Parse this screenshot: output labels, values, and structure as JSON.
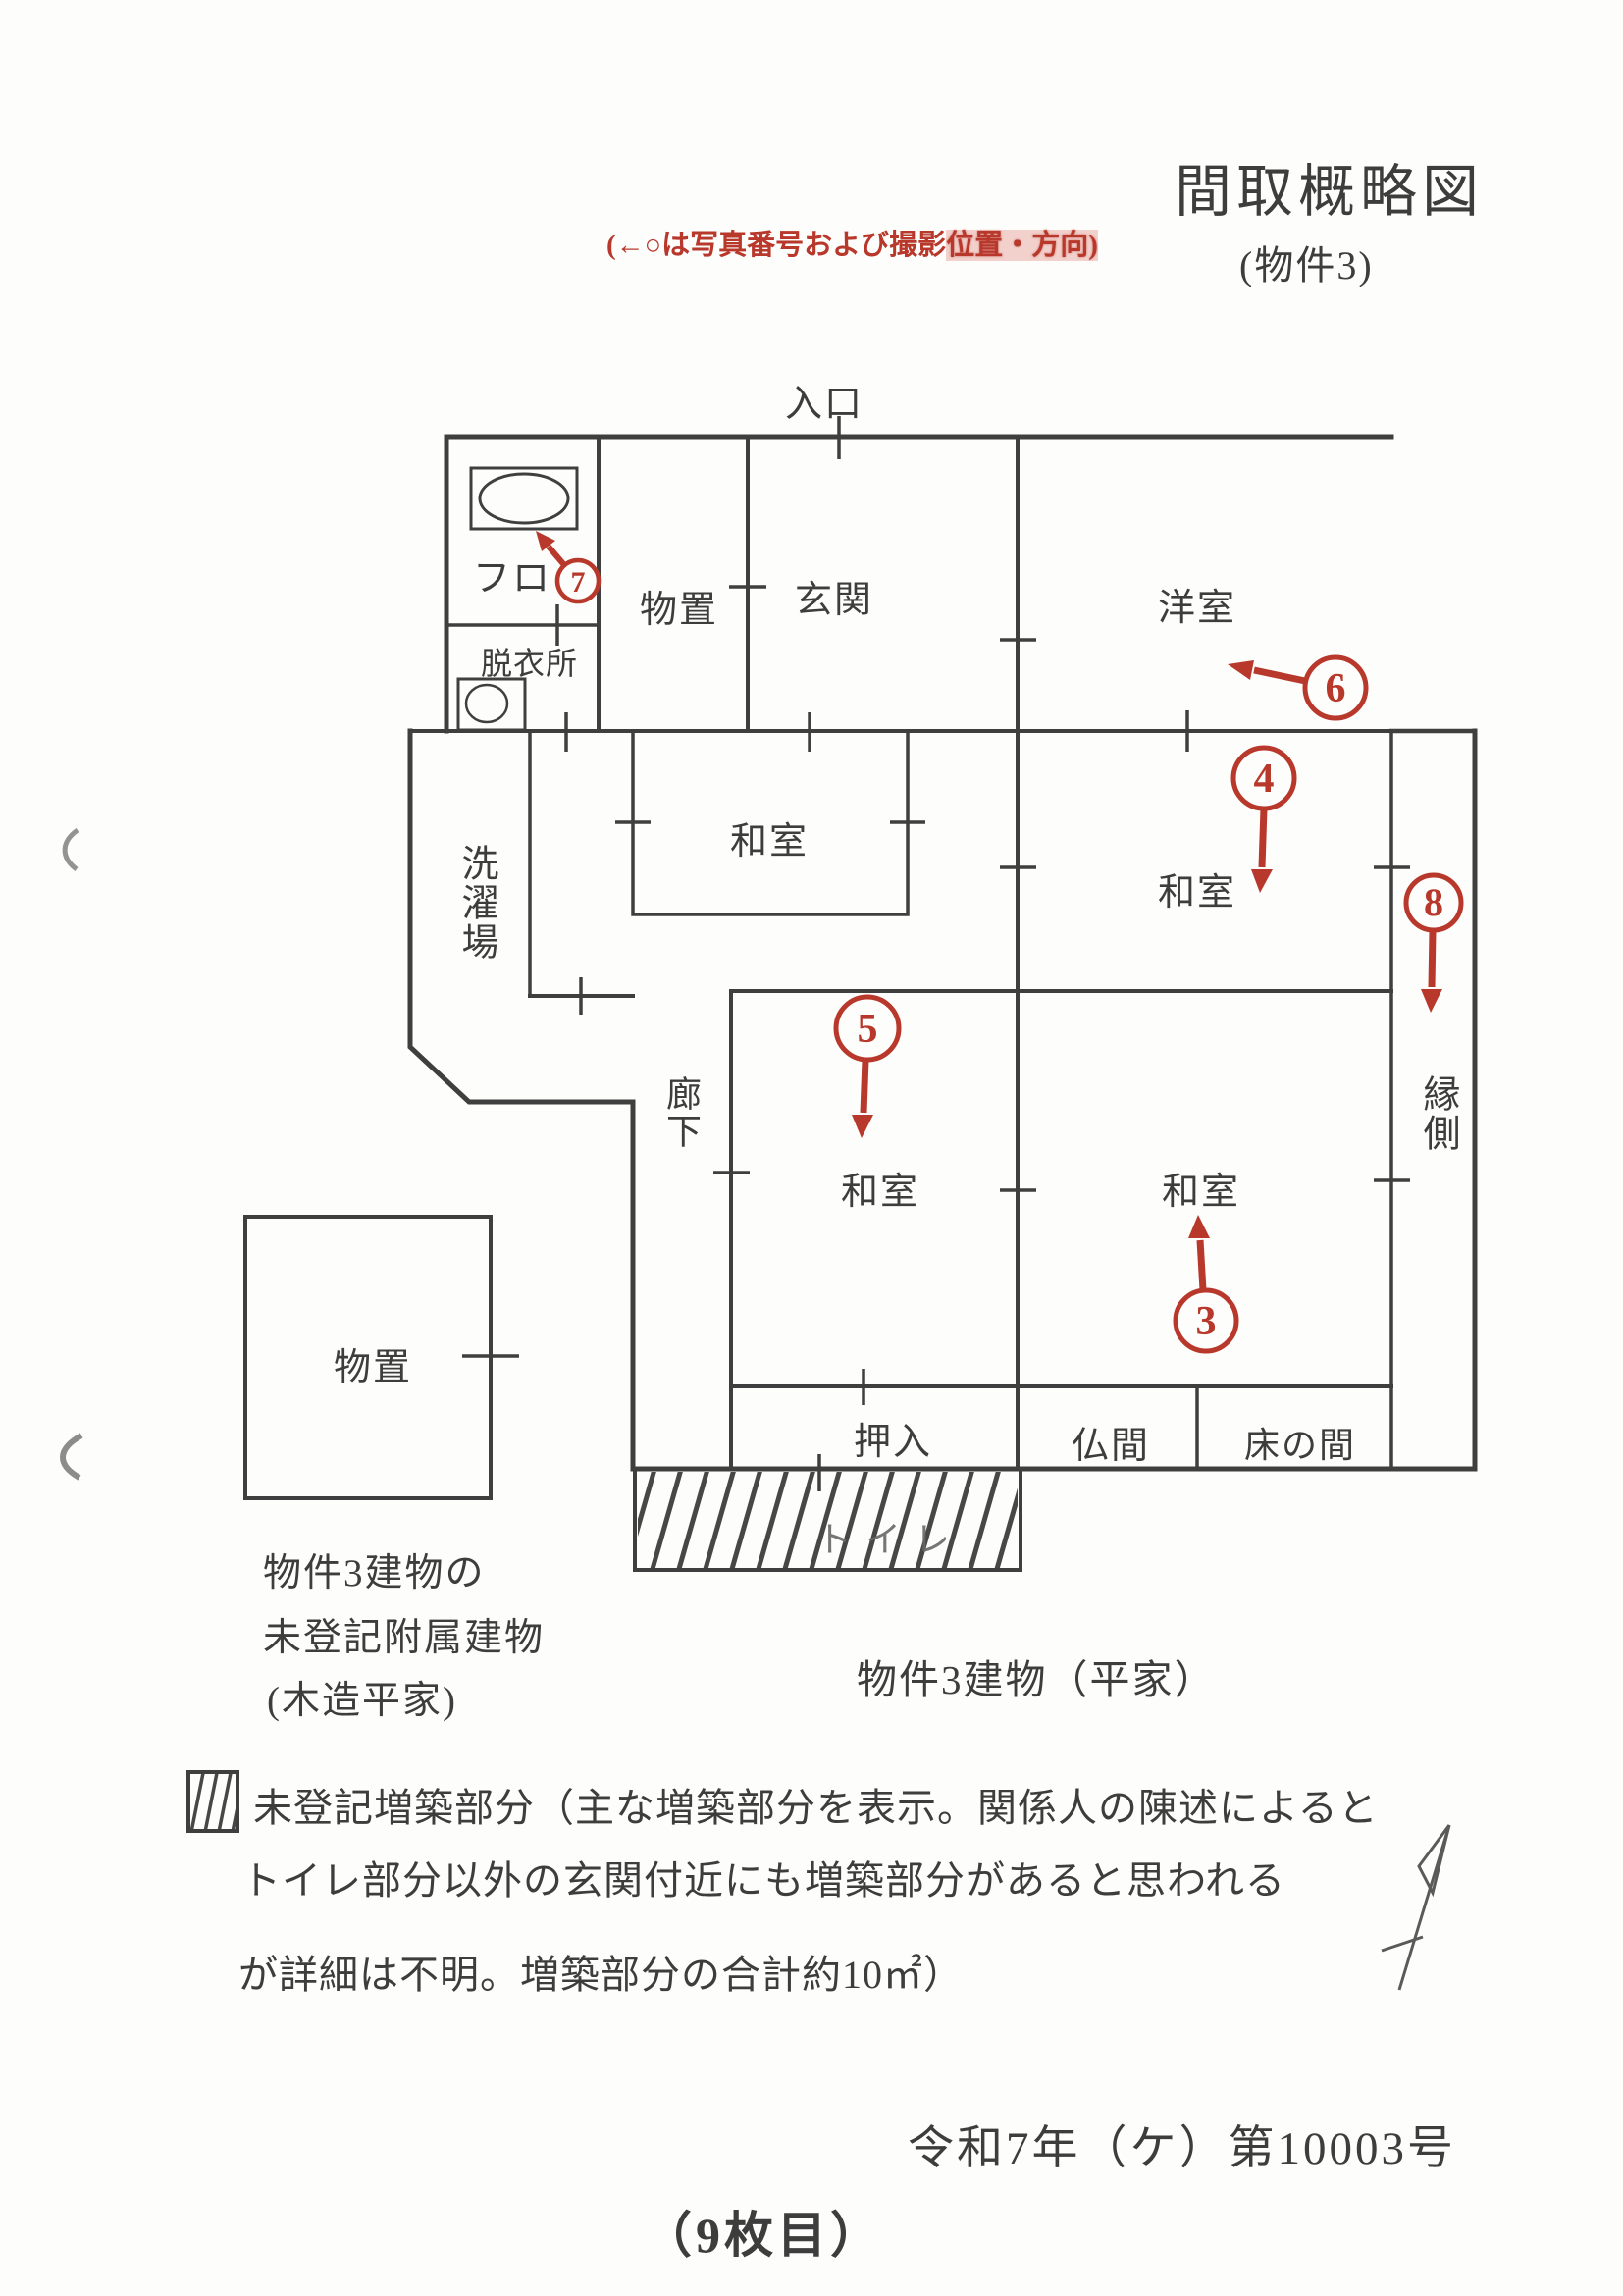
{
  "header": {
    "note_prefix": "(←○は写真番号および撮影",
    "note_suffix": "位置・方向)",
    "title": "間取概略図",
    "subtitle": "(物件3)"
  },
  "plan": {
    "rooms": {
      "entrance": "入口",
      "bath": "フロ",
      "dressing_room": "脱衣所",
      "storage": "物置",
      "genkan": "玄関",
      "western_room": "洋室",
      "laundry": "洗濯場",
      "washitsu_nw": "和室",
      "washitsu_east": "和室",
      "washitsu_center": "和室",
      "washitsu_south": "和室",
      "corridor": "廊下",
      "veranda": "縁側",
      "closet": "押入",
      "altar_room": "仏間",
      "tokonoma": "床の間",
      "toilet": "トイレ",
      "annex_storage": "物置"
    },
    "markers": {
      "3": "3",
      "4": "4",
      "5": "5",
      "6": "6",
      "7": "7",
      "8": "8"
    }
  },
  "captions": {
    "annex_line1": "物件3建物の",
    "annex_line2": "未登記附属建物",
    "annex_line3": "(木造平家)",
    "main_building": "物件3建物（平家）"
  },
  "legend": {
    "line1": "未登記増築部分（主な増築部分を表示。関係人の陳述によると",
    "line2": "トイレ部分以外の玄関付近にも増築部分があると思われる",
    "line3": "が詳細は不明。増築部分の合計約10㎡）"
  },
  "footer": {
    "case_number": "令和7年（ケ）第10003号",
    "page_number": "（9枚目）"
  },
  "colors": {
    "annotation_red": "#b8382c",
    "wall_ink": "#3f3f3f"
  }
}
